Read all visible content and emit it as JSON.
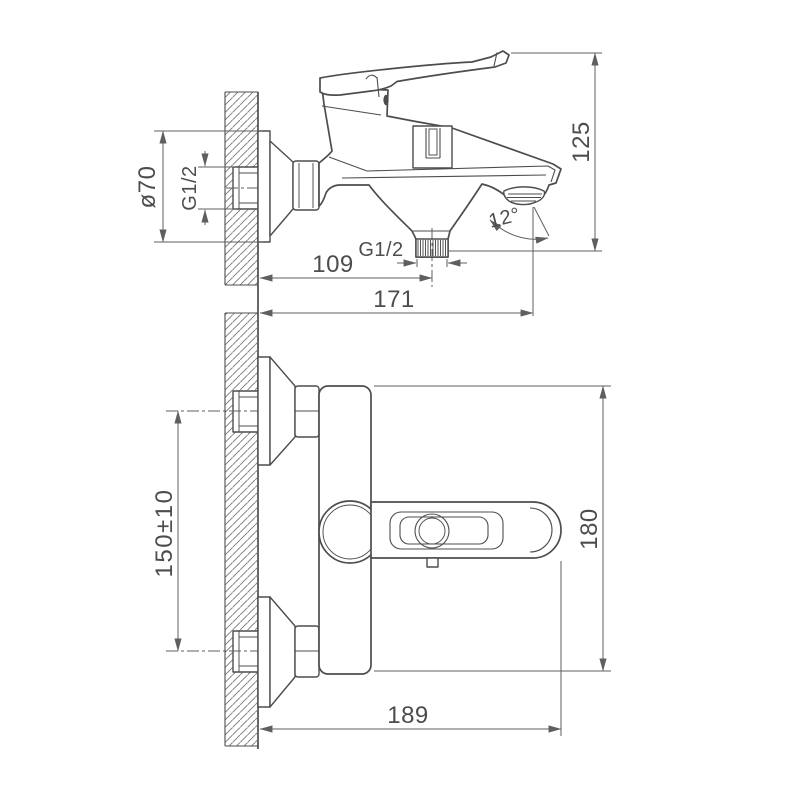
{
  "drawing": {
    "kind": "technical dimension drawing",
    "subject": "wall-mounted bath/shower single-lever mixer faucet, two orthographic views",
    "background": "#ffffff",
    "line_color": "#4d4d4d",
    "dimension_color": "#5f5f5f"
  },
  "side_view": {
    "name": "side view (spout, shower outlet, wall section)",
    "labels": {
      "escutcheon_diameter": "ø70",
      "inlet_thread": "G1/2",
      "shower_outlet_thread": "G1/2",
      "wall_to_shower_outlet_mm": "109",
      "wall_to_spout_tip_mm": "171",
      "lever_to_spout_height_mm": "125",
      "spout_angle_deg": "12°"
    }
  },
  "plan_view": {
    "name": "plan view (handle, inlet connections)",
    "labels": {
      "inlet_spacing_mm": "150±10",
      "overall_depth_mm": "180",
      "wall_to_handle_end_mm": "189"
    }
  }
}
